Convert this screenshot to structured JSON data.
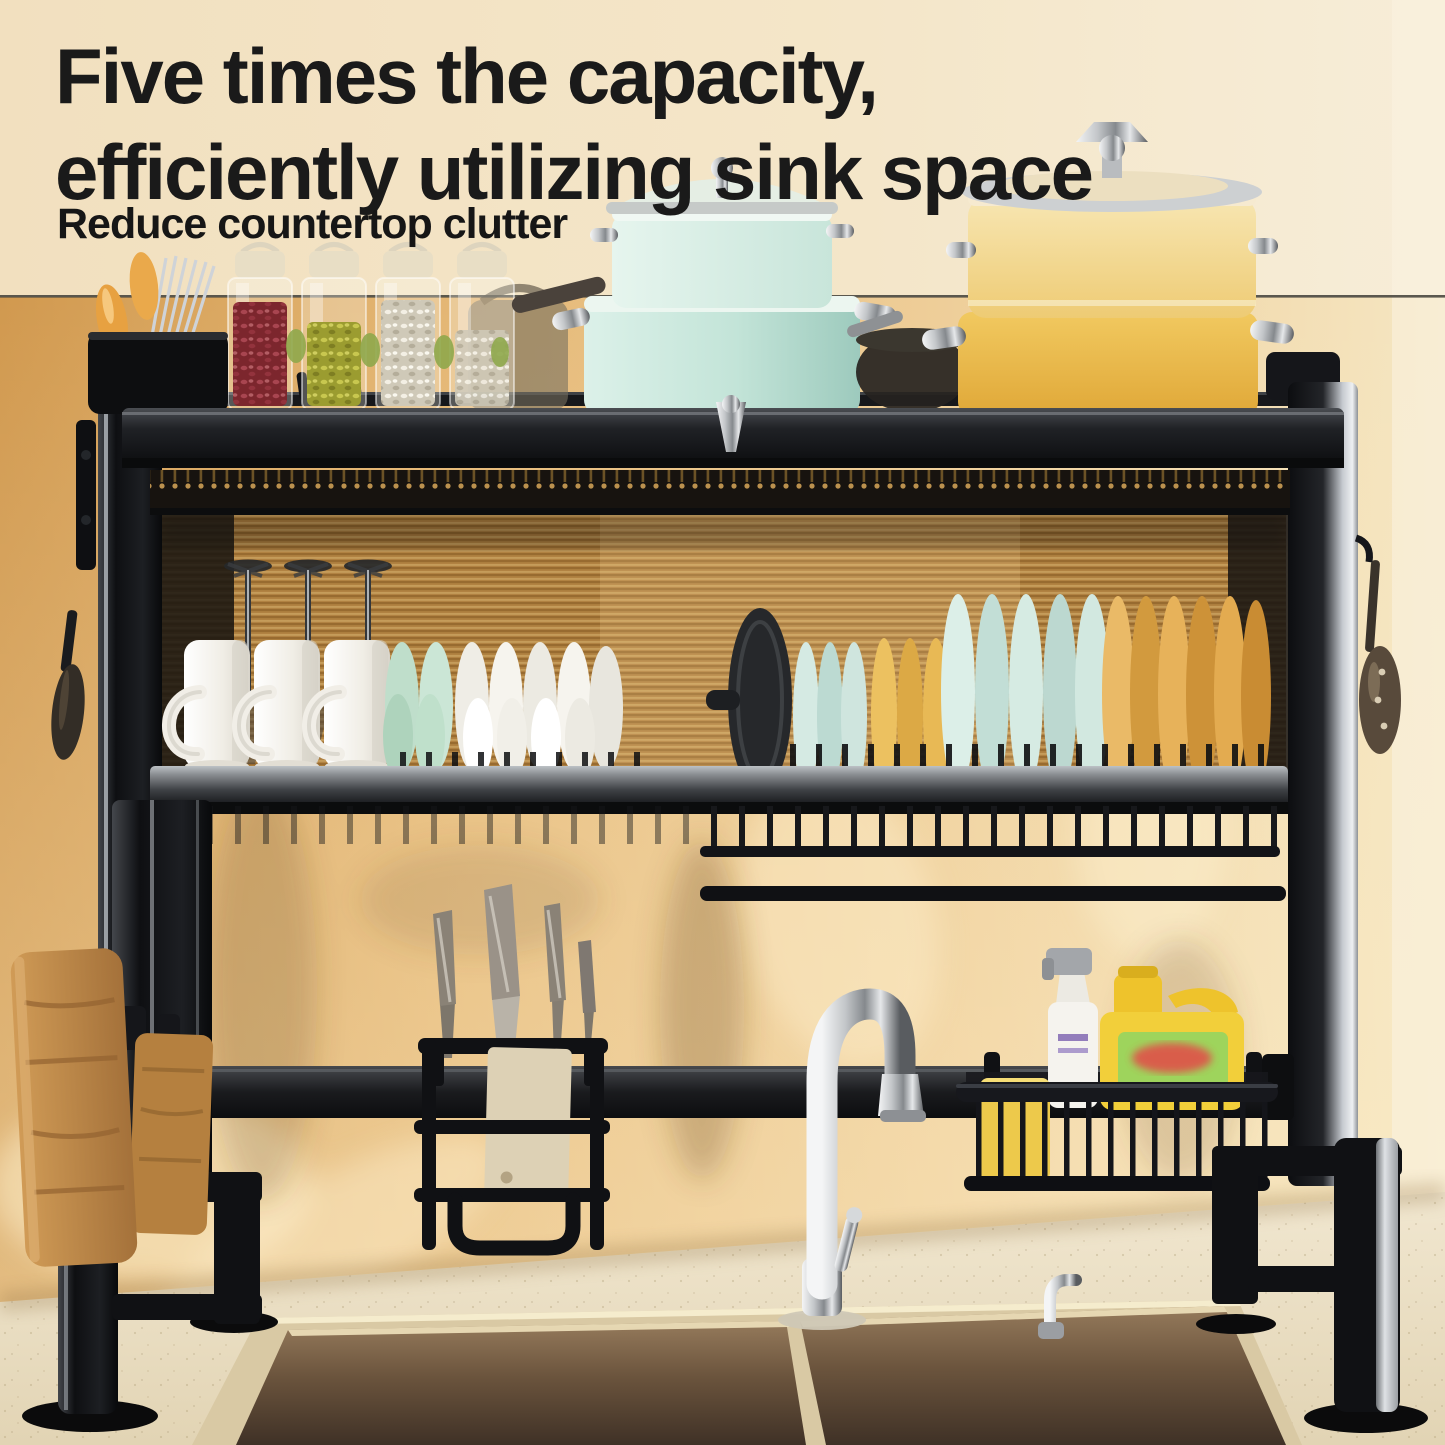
{
  "header": {
    "headline_line1": "Five times the capacity,",
    "headline_line2": "efficiently utilizing sink space",
    "subheadline": "Reduce countertop clutter",
    "text_color": "#1a1a1a"
  },
  "palette": {
    "wall_top_cream": "#f3e2c2",
    "wall_warm_amber": "#e0b26c",
    "divider_line": "#49473f",
    "rack_black": "#111215",
    "rail_silver": "#9ba0a4",
    "ribbed_glass": "#c3924c",
    "teal_pot": "#cfe9df",
    "yellow_pot": "#eec05a",
    "mint_dish": "#cde5da",
    "amber_plate": "#dfa64e",
    "wood_board": "#c08a48",
    "soap_jug_yellow": "#f0cc3a",
    "soap_label_green": "#9ed45c",
    "sponge_yellow": "#edc94b",
    "counter_cream": "#ece1c8",
    "sink_bronze": "#6e5942",
    "chrome": "#d9dbdd"
  },
  "scene": {
    "description": "Black two-tier over-the-sink dish drying rack standing over a double-bowl kitchen sink against a warm amber wall",
    "objects": [
      {
        "name": "spice-jars",
        "label": "Glass jars with red, olive and white beans"
      },
      {
        "name": "utensil-cup",
        "label": "Holder with chopsticks and orange spoons"
      },
      {
        "name": "teal-pot-stack",
        "label": "Stacked mint-green pots with glass lid"
      },
      {
        "name": "yellow-pot-stack",
        "label": "Stacked yellow stock pots with lid"
      },
      {
        "name": "wine-glasses",
        "label": "Three upside-down wine glasses"
      },
      {
        "name": "mugs",
        "label": "Three white mugs drying upside down"
      },
      {
        "name": "bowls",
        "label": "Mint and white bowls on edge"
      },
      {
        "name": "plates",
        "label": "Mint and amber plates in plate rack"
      },
      {
        "name": "pot-lid",
        "label": "Dark pot lid in plate rack"
      },
      {
        "name": "knife-rack",
        "label": "Hanging knife holder with four knives"
      },
      {
        "name": "cutting-boards",
        "label": "Two wooden cutting boards on hooks"
      },
      {
        "name": "wire-basket",
        "label": "Basket with sponge, spray bottle and dish soap jug"
      },
      {
        "name": "faucet",
        "label": "Chrome gooseneck faucet"
      },
      {
        "name": "soap-dispenser",
        "label": "Chrome counter soap dispenser"
      },
      {
        "name": "double-sink",
        "label": "Double-bowl bronze stainless sink"
      },
      {
        "name": "hanging-utensils",
        "label": "Utensils hanging on side hooks"
      }
    ]
  }
}
